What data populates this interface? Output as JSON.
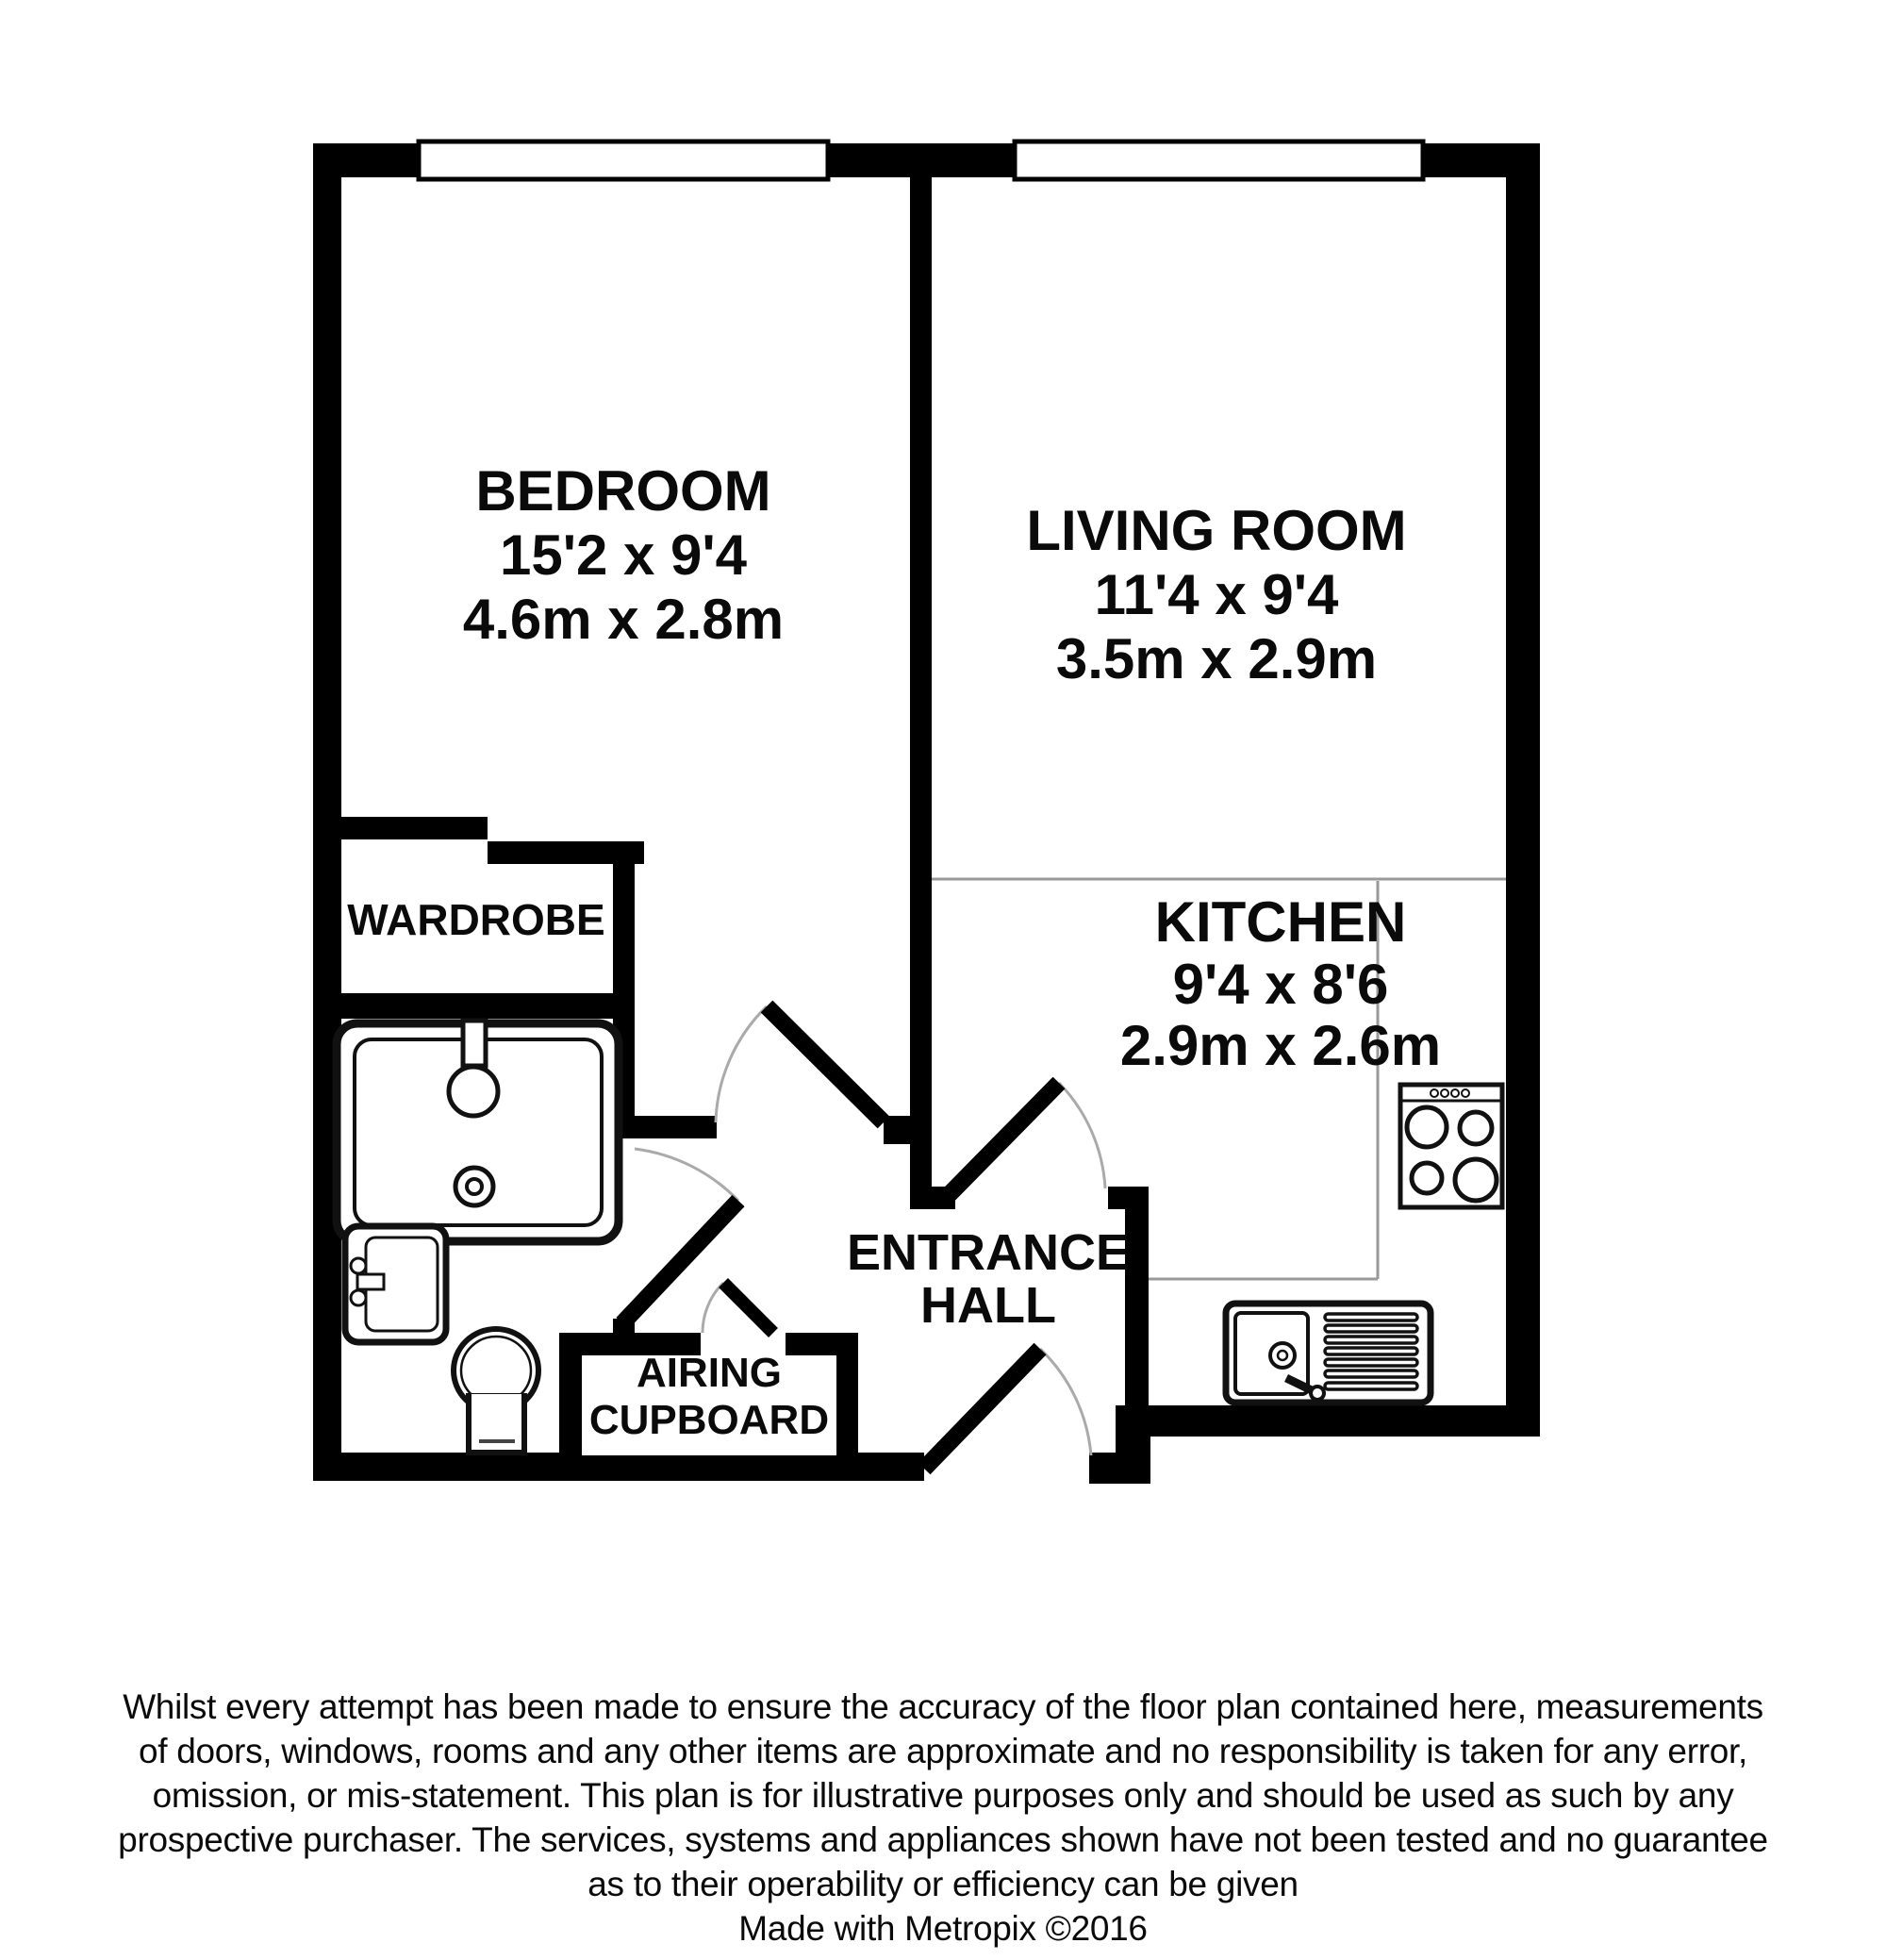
{
  "plan": {
    "bedroom": {
      "label": "BEDROOM",
      "imperial": "15'2 x 9'4",
      "metric": "4.6m x 2.8m"
    },
    "living_room": {
      "label": "LIVING ROOM",
      "imperial": "11'4 x 9'4",
      "metric": "3.5m x 2.9m"
    },
    "kitchen": {
      "label": "KITCHEN",
      "imperial": "9'4 x 8'6",
      "metric": "2.9m x 2.6m"
    },
    "wardrobe": {
      "label": "WARDROBE"
    },
    "entrance_hall": {
      "label_line1": "ENTRANCE",
      "label_line2": "HALL"
    },
    "airing_cupboard": {
      "label_line1": "AIRING",
      "label_line2": "CUPBOARD"
    }
  },
  "footer": {
    "disclaimer_lines": [
      "Whilst every attempt has been made to ensure the accuracy of the floor plan contained here, measurements",
      "of doors, windows, rooms and any other items are approximate and no responsibility is taken for any error,",
      "omission, or mis-statement. This plan is for illustrative purposes only and should be used as such by any",
      "prospective purchaser. The services, systems and appliances shown have not been tested and no guarantee",
      "as to their operability or efficiency can be given"
    ],
    "credit": "Made with Metropix ©2016"
  },
  "colors": {
    "wall": "#000000",
    "background": "#ffffff",
    "thin_line": "#999999",
    "door_arc": "#aaaaaa",
    "fixture_outline": "#111111"
  }
}
